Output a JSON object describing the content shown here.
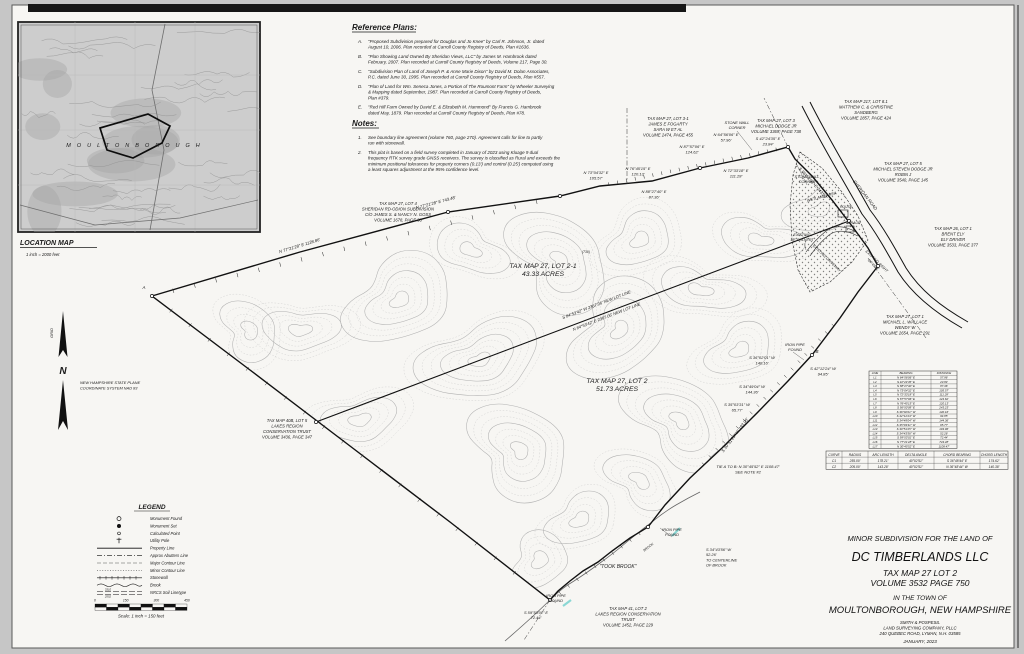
{
  "location_map": {
    "title": "LOCATION MAP",
    "scale": "1 inch = 2000 feet",
    "town_label": "MOULTONBOROUGH"
  },
  "north_arrow": {
    "n": "N",
    "grid": "GRID",
    "datum_lines": [
      "NEW HAMPSHIRE STATE PLANE",
      "COORDINATE SYSTEM NAD 83"
    ]
  },
  "reference_plans": {
    "heading": "Reference Plans:",
    "items": [
      {
        "id": "A.",
        "lines": [
          "\"Proposed Subdivision prepared for Douglas and Jo Knee\" by Carl R. Johnson, Jr. dated",
          "August 10, 2006. Plan recorded at Carroll County Registry of Deeds, Plan #1636."
        ]
      },
      {
        "id": "B.",
        "lines": [
          "\"Plan Showing Land Owned By Sheridan Views, LLC\" by James M. Hambrook dated",
          "February, 2007. Plan recorded at Carroll County Registry of Deeds, Volume 217, Page 30."
        ]
      },
      {
        "id": "C.",
        "lines": [
          "\"Subdivision Plan of Land of Joseph P. & Anne Marie Dixon\" by David M. Dolan Associates,",
          "P.C. dated June 30, 1995. Plan recorded at Carroll County Registry of Deeds, Plan #557."
        ]
      },
      {
        "id": "D.",
        "lines": [
          "\"Plan of Land for Wm. Seneca Jones, a Portion of The Roumont Farm\" by Wheeler Surveying",
          "& Mapping dated September, 1987. Plan recorded at Carroll County Registry of Deeds,",
          "Plan #379."
        ]
      },
      {
        "id": "E.",
        "lines": [
          "\"Red Hill Farm Owned by David E. & Elizabeth M. Hammond\" By Francis G. Hambrook",
          "dated May, 1879. Plan recorded at Carroll County Registry of Deeds, Plan #78."
        ]
      }
    ]
  },
  "notes": {
    "heading": "Notes:",
    "items": [
      {
        "id": "1.",
        "lines": [
          "See boundary line agreement (volume 760, page 270). Agreement calls for line to partly",
          "run with stonewall."
        ]
      },
      {
        "id": "2.",
        "lines": [
          "This plat is based on a field survey completed in January of 2023 using Kluage 9 dual",
          "frequency RTK survey grade GNSS receivers. The survey is classified as Rural and exceeds the",
          "minimum positional tolerances for property corners (0.13') and control (0.25') computed using",
          "a least squares adjustment at the 95% confidence level."
        ]
      }
    ]
  },
  "legend": {
    "title": "LEGEND",
    "items": [
      {
        "symbol": "circle-open",
        "label": "Monument Found"
      },
      {
        "symbol": "circle-filled",
        "label": "Monument Set"
      },
      {
        "symbol": "circle-dot",
        "label": "Calculated Point"
      },
      {
        "symbol": "utility-pole",
        "label": "Utility Pole"
      },
      {
        "symbol": "line-solid",
        "label": "Property Line"
      },
      {
        "symbol": "line-dash-dot",
        "label": "Approx Abutters Line"
      },
      {
        "symbol": "line-dash",
        "label": "Major Contour Line"
      },
      {
        "symbol": "line-dot",
        "label": "Minor Contour Line"
      },
      {
        "symbol": "line-stonewall",
        "label": "Stonewall"
      },
      {
        "symbol": "line-brook",
        "label": "Brook"
      },
      {
        "symbol": "line-soil",
        "label": "NRCS Soil Linetype",
        "top": "3310",
        "bottom": "2552"
      }
    ],
    "scale_ticks": [
      "0",
      "150",
      "300",
      "450"
    ],
    "scale_text": "Scale: 1 inch = 150 feet"
  },
  "map_labels": [
    {
      "lines": [
        "TAX MAP 27, LOT 2-1",
        "43.33 ACRES"
      ],
      "x": 543,
      "y": 268,
      "size": 6.8
    },
    {
      "lines": [
        "TAX MAP 27, LOT 2",
        "51.73 ACRES"
      ],
      "x": 617,
      "y": 383,
      "size": 6.8
    },
    {
      "lines": [
        "TAX MAP 27, LOT 4",
        "SHERIDAN RD-ODION SUBDIVISION",
        "C/O JAMES S. & NANCY N. GOSS",
        "VOLUME 1678, PAGE 33"
      ],
      "x": 398,
      "y": 205,
      "size": 4.2
    },
    {
      "lines": [
        "TAX MAP 27, LOT 3-1",
        "JAMES E FOGARTY",
        "SARA W ET AL",
        "VOLUME 2474, PAGE 455"
      ],
      "x": 668,
      "y": 120,
      "size": 4.2
    },
    {
      "lines": [
        "TAX MAP 27, LOT 3",
        "MICHAEL DODGE JR",
        "VOLUME 3369, PAGE 738"
      ],
      "x": 776,
      "y": 122,
      "size": 4.2
    },
    {
      "lines": [
        "TAX MAP 217, LOT 8.1",
        "MATTHEW C. & CHRISTINE",
        "SANDBERG",
        "VOLUME 2857, PAGE 424"
      ],
      "x": 866,
      "y": 103,
      "size": 4.2
    },
    {
      "lines": [
        "TAX MAP 27, LOT 5",
        "MICHAEL STEVEN DODGE JR",
        "ROBIN J",
        "VOLUME 3540, PAGE 145"
      ],
      "x": 903,
      "y": 165,
      "size": 4.2
    },
    {
      "lines": [
        "TAX MAP 26, LOT 1",
        "BRENT ELY",
        "ELY DRIVER",
        "VOLUME 3533, PAGE 377"
      ],
      "x": 953,
      "y": 230,
      "size": 4.2
    },
    {
      "lines": [
        "TAX MAP 27, LOT 1",
        "MICHAEL L. WALLACE",
        "WENDY W",
        "VOLUME 2654, PAGE 291"
      ],
      "x": 905,
      "y": 318,
      "size": 4.2
    },
    {
      "lines": [
        "TAX MAP 40B, LOT 5",
        "LAKES REGION",
        "CONSERVATION TRUST",
        "VOLUME 3436, PAGE 347"
      ],
      "x": 287,
      "y": 422,
      "size": 4.2
    },
    {
      "lines": [
        "TAX MAP 41, LOT 2",
        "LAKES REGION CONSERVATION",
        "TRUST",
        "VOLUME 1452, PAGE 229"
      ],
      "x": 628,
      "y": 610,
      "size": 4.2
    },
    {
      "lines": [
        "N 77°21'28\" E  1128.86'"
      ],
      "x": 300,
      "y": 247,
      "rot": -17,
      "size": 4.2
    },
    {
      "lines": [
        "N 77°21'28\" E  743.48'"
      ],
      "x": 436,
      "y": 204,
      "rot": -15,
      "size": 4.2
    },
    {
      "lines": [
        "N 73°04'32\" E",
        "105.57'"
      ],
      "x": 596,
      "y": 174,
      "size": 4
    },
    {
      "lines": [
        "N 88°27'40\" E",
        "87.36'"
      ],
      "x": 654,
      "y": 193,
      "size": 4
    },
    {
      "lines": [
        "N 76°45'15\" E",
        "120.13'"
      ],
      "x": 638,
      "y": 170,
      "size": 4
    },
    {
      "lines": [
        "N 87°57'06\" E",
        "124.62'"
      ],
      "x": 692,
      "y": 148,
      "size": 4
    },
    {
      "lines": [
        "N 64°56'06\" E",
        "57.96'"
      ],
      "x": 726,
      "y": 136,
      "size": 4
    },
    {
      "lines": [
        "S 42°24'35\" E",
        "23.84'"
      ],
      "x": 768,
      "y": 140,
      "size": 4
    },
    {
      "lines": [
        "N 72°33'18\" E",
        "111.28'"
      ],
      "x": 736,
      "y": 172,
      "size": 4
    },
    {
      "lines": [
        "S 56°50'09\" E  243.23'"
      ],
      "x": 812,
      "y": 184,
      "rot": 48,
      "size": 4.2
    },
    {
      "lines": [
        "S 36°02'01\" W",
        "140.16'"
      ],
      "x": 762,
      "y": 359,
      "size": 4
    },
    {
      "lines": [
        "S 42°12'24\" W",
        "94.85'"
      ],
      "x": 823,
      "y": 370,
      "size": 4
    },
    {
      "lines": [
        "S 34°49'04\" W",
        "144.36'"
      ],
      "x": 752,
      "y": 388,
      "size": 4
    },
    {
      "lines": [
        "S 35°03'31\" W",
        "65.77'"
      ],
      "x": 737,
      "y": 406,
      "size": 4
    },
    {
      "lines": [
        "S 30°51'25\" W  193.96'"
      ],
      "x": 736,
      "y": 436,
      "rot": -53,
      "size": 4.2
    },
    {
      "lines": [
        "IRON PIPE",
        "FOUND"
      ],
      "x": 795,
      "y": 346,
      "size": 3.9
    },
    {
      "lines": [
        "B"
      ],
      "x": 817,
      "y": 353,
      "size": 4.5
    },
    {
      "lines": [
        "TIE A TO B: N 30°45'52\" E  1108.47'",
        "SEE NOTE #2"
      ],
      "x": 748,
      "y": 468,
      "size": 4
    },
    {
      "lines": [
        "IRON PIPE",
        "FOUND"
      ],
      "x": 672,
      "y": 531,
      "size": 3.9
    },
    {
      "lines": [
        "S 34°43'56\" W",
        "52.26'",
        "TO CENTERLINE",
        "OF BROOK"
      ],
      "x": 706,
      "y": 551,
      "size": 3.9,
      "anchor": "start"
    },
    {
      "lines": [
        "IRON PIPE",
        "FOUND"
      ],
      "x": 556,
      "y": 597,
      "size": 3.9
    },
    {
      "lines": [
        "S 59°53'01\" E",
        "72.44'"
      ],
      "x": 536,
      "y": 614,
      "size": 3.9
    },
    {
      "lines": [
        "\"TOOK BROOK\""
      ],
      "x": 618,
      "y": 568,
      "size": 5
    },
    {
      "lines": [
        "STONE WALL",
        "CORNER"
      ],
      "x": 737,
      "y": 124,
      "size": 3.9
    },
    {
      "lines": [
        "STONE WALL",
        "CORNER"
      ],
      "x": 807,
      "y": 178,
      "size": 3.9
    },
    {
      "lines": [
        "WETLAND AREA"
      ],
      "x": 822,
      "y": 198,
      "rot": -15,
      "size": 3.9
    },
    {
      "lines": [
        "EXISTING",
        "18\" CULVERT"
      ],
      "x": 802,
      "y": 236,
      "size": 3.7
    },
    {
      "lines": [
        "EXISTING DRIVEWAY"
      ],
      "x": 826,
      "y": 259,
      "rot": 44,
      "size": 3.7
    },
    {
      "lines": [
        "EXISTING RIGHT",
        "OF WAY"
      ],
      "x": 876,
      "y": 262,
      "rot": 44,
      "size": 3.7
    },
    {
      "lines": [
        "HOUSE"
      ],
      "x": 846,
      "y": 208,
      "size": 3.4
    },
    {
      "lines": [
        "GARAGE"
      ],
      "x": 853,
      "y": 224,
      "size": 3.4
    },
    {
      "lines": [
        "SHERIDAN ROAD"
      ],
      "x": 864,
      "y": 196,
      "rot": 52,
      "size": 4.4
    },
    {
      "lines": [
        "S 84°53'42\" W  2367.06'  NEW LOT LINE"
      ],
      "x": 597,
      "y": 306,
      "rot": -21,
      "size": 4.1
    },
    {
      "lines": [
        "N 84°53'42\" E  2367.06'  NEW LOT LINE"
      ],
      "x": 607,
      "y": 318,
      "rot": -21,
      "size": 4.1
    },
    {
      "lines": [
        "A"
      ],
      "x": 144,
      "y": 289,
      "size": 4.5
    },
    {
      "lines": [
        "(730)"
      ],
      "x": 586,
      "y": 253,
      "size": 3.4
    },
    {
      "lines": [
        "BROOK"
      ],
      "x": 649,
      "y": 548,
      "rot": -38,
      "size": 3.3
    }
  ],
  "line_table": {
    "headers": [
      "LINE",
      "BEARING",
      "DISTANCE"
    ],
    "rows": [
      [
        "L1",
        "N 64°56'06\" E",
        "57.96'"
      ],
      [
        "L2",
        "S 42°24'35\" E",
        "23.84'"
      ],
      [
        "L3",
        "N 88°27'40\" E",
        "87.36'"
      ],
      [
        "L4",
        "N 73°04'32\" E",
        "105.57'"
      ],
      [
        "L5",
        "N 72°33'18\" E",
        "111.28'"
      ],
      [
        "L6",
        "N 87°57'06\" E",
        "124.62'"
      ],
      [
        "L7",
        "N 76°45'15\" E",
        "120.13'"
      ],
      [
        "L8",
        "S 56°50'09\" E",
        "243.23'"
      ],
      [
        "L9",
        "S 36°02'01\" W",
        "140.16'"
      ],
      [
        "L10",
        "S 42°12'24\" W",
        "94.85'"
      ],
      [
        "L11",
        "S 34°49'04\" W",
        "144.36'"
      ],
      [
        "L12",
        "S 35°03'31\" W",
        "65.77'"
      ],
      [
        "L13",
        "S 30°51'25\" W",
        "193.96'"
      ],
      [
        "L14",
        "S 34°43'56\" W",
        "52.26'"
      ],
      [
        "L15",
        "S 59°53'01\" E",
        "72.44'"
      ],
      [
        "L16",
        "N 77°21'28\" E",
        "743.48'"
      ],
      [
        "L17",
        "N 30°45'52\" E",
        "1108.47'"
      ]
    ]
  },
  "curve_table": {
    "headers": [
      "CURVE",
      "RADIUS",
      "ARC LENGTH",
      "DELTA ANGLE",
      "CHORD BEARING",
      "CHORD LENGTH"
    ],
    "rows": [
      [
        "C1",
        "255.00'",
        "178.21'",
        "40°02'51\"",
        "S 36°48'44\" E",
        "174.62'"
      ],
      [
        "C2",
        "205.00'",
        "143.28'",
        "40°02'51\"",
        "N 36°48'44\" W",
        "140.38'"
      ]
    ]
  },
  "title_block": {
    "line1": "MINOR SUBDIVISION FOR THE LAND OF",
    "owner": "DC TIMBERLANDS LLC",
    "lot": "TAX MAP 27 LOT 2",
    "volume": "VOLUME 3532 PAGE 750",
    "town_intro": "IN THE TOWN OF",
    "town": "MOULTONBOROUGH, NEW HAMPSHIRE",
    "surveyor": [
      "SMITH & POSPESIL",
      "LAND SURVEYING COMPANY, PLLC",
      "240 QUEBEC ROAD, LYMAN, N.H. 03585"
    ],
    "date": "JANUARY, 2023"
  }
}
